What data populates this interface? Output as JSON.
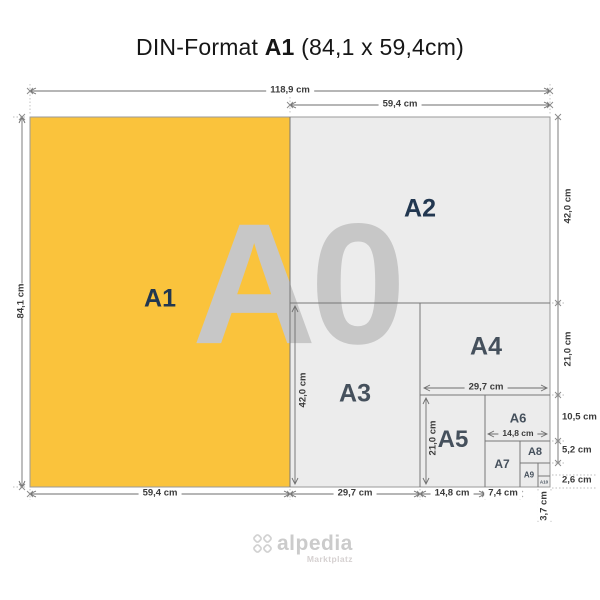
{
  "title": {
    "prefix": "DIN-Format",
    "highlight": "A1",
    "suffix": "(84,1 x 59,4cm)"
  },
  "watermark": "A0",
  "sheets": {
    "a1": "A1",
    "a2": "A2",
    "a3": "A3",
    "a4": "A4",
    "a5": "A5",
    "a6": "A6",
    "a7": "A7",
    "a8": "A8",
    "a9": "A9",
    "a10": "A10"
  },
  "dims": {
    "top_total_width": "118,9 cm",
    "top_right_width": "59,4 cm",
    "left_height": "84,1 cm",
    "right_a2_height": "42,0 cm",
    "right_a4_height": "21,0 cm",
    "right_a6_height": "10,5 cm",
    "right_a8_height": "5,2 cm",
    "right_a10_height": "2,6 cm",
    "bottom_a1_width": "59,4 cm",
    "bottom_a3_width": "29,7 cm",
    "bottom_a5_width": "14,8 cm",
    "bottom_a7_width": "7,4 cm",
    "bottom_a10_width": "3,7 cm",
    "inner_a3_height": "42,0 cm",
    "inner_a5_height": "21,0 cm",
    "inner_a4_width": "29,7 cm",
    "inner_a6_width": "14,8 cm"
  },
  "logo": {
    "name": "alpedia",
    "tagline": "Marktplatz"
  },
  "colors": {
    "a1_fill": "#FAC33C",
    "paper_fill": "#ECECEC",
    "watermark": "#C7C7C7",
    "sheet_label": "#223750",
    "dimension_text": "#3B3B3B"
  }
}
